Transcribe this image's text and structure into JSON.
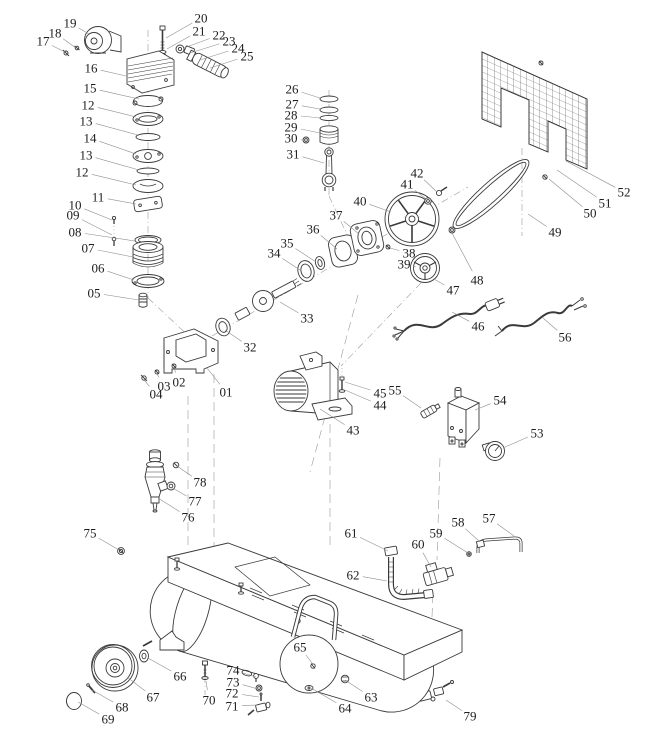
{
  "diagram": {
    "type": "exploded-parts-diagram",
    "subject": "air-compressor",
    "canvas": {
      "width": 649,
      "height": 755
    },
    "colors": {
      "background": "#ffffff",
      "line": "#3a3a3a",
      "leader": "#8f8f8f",
      "construction": "#9a9a9a",
      "label": "#1d1d1d"
    },
    "label_font_size": 13,
    "part_labels": [
      {
        "num": "01",
        "x": 226,
        "y": 392,
        "tx": 207,
        "ty": 368
      },
      {
        "num": "02",
        "x": 179,
        "y": 382,
        "tx": 174,
        "ty": 368
      },
      {
        "num": "03",
        "x": 164,
        "y": 386,
        "tx": 157,
        "ty": 374
      },
      {
        "num": "04",
        "x": 156,
        "y": 394,
        "tx": 144,
        "ty": 380
      },
      {
        "num": "05",
        "x": 94,
        "y": 293,
        "tx": 139,
        "ty": 300
      },
      {
        "num": "06",
        "x": 98,
        "y": 268,
        "tx": 134,
        "ty": 280
      },
      {
        "num": "07",
        "x": 88,
        "y": 248,
        "tx": 133,
        "ty": 257
      },
      {
        "num": "08",
        "x": 75,
        "y": 232,
        "tx": 135,
        "ty": 241
      },
      {
        "num": "09",
        "x": 73,
        "y": 215,
        "tx": 112,
        "ty": 235
      },
      {
        "num": "10",
        "x": 75,
        "y": 205,
        "tx": 112,
        "ty": 220
      },
      {
        "num": "11",
        "x": 98,
        "y": 197,
        "tx": 136,
        "ty": 204
      },
      {
        "num": "12",
        "x": 88,
        "y": 105,
        "tx": 136,
        "ty": 117
      },
      {
        "num": "13",
        "x": 86,
        "y": 121,
        "tx": 138,
        "ty": 135
      },
      {
        "num": "14",
        "x": 90,
        "y": 138,
        "tx": 136,
        "ty": 154
      },
      {
        "num": "13",
        "x": 86,
        "y": 155,
        "tx": 139,
        "ty": 170
      },
      {
        "num": "12",
        "x": 82,
        "y": 172,
        "tx": 136,
        "ty": 185
      },
      {
        "num": "15",
        "x": 90,
        "y": 88,
        "tx": 139,
        "ty": 99
      },
      {
        "num": "16",
        "x": 91,
        "y": 68,
        "tx": 126,
        "ty": 76
      },
      {
        "num": "17",
        "x": 43,
        "y": 41,
        "tx": 65,
        "ty": 52
      },
      {
        "num": "18",
        "x": 55,
        "y": 33,
        "tx": 76,
        "ty": 48
      },
      {
        "num": "19",
        "x": 70,
        "y": 23,
        "tx": 89,
        "ty": 34
      },
      {
        "num": "20",
        "x": 201,
        "y": 18,
        "tx": 166,
        "ty": 38
      },
      {
        "num": "21",
        "x": 199,
        "y": 31,
        "tx": 167,
        "ty": 49
      },
      {
        "num": "22",
        "x": 219,
        "y": 35,
        "tx": 184,
        "ty": 48
      },
      {
        "num": "23",
        "x": 229,
        "y": 41,
        "tx": 190,
        "ty": 53
      },
      {
        "num": "24",
        "x": 238,
        "y": 48,
        "tx": 200,
        "ty": 60
      },
      {
        "num": "25",
        "x": 247,
        "y": 56,
        "tx": 210,
        "ty": 68
      },
      {
        "num": "26",
        "x": 292,
        "y": 89,
        "tx": 320,
        "ty": 98
      },
      {
        "num": "27",
        "x": 292,
        "y": 104,
        "tx": 320,
        "ty": 109
      },
      {
        "num": "28",
        "x": 291,
        "y": 115,
        "tx": 320,
        "ty": 118
      },
      {
        "num": "29",
        "x": 291,
        "y": 127,
        "tx": 320,
        "ty": 133
      },
      {
        "num": "30",
        "x": 291,
        "y": 138,
        "tx": 304,
        "ty": 140
      },
      {
        "num": "31",
        "x": 293,
        "y": 154,
        "tx": 324,
        "ty": 163
      },
      {
        "num": "32",
        "x": 250,
        "y": 347,
        "tx": 225,
        "ty": 330
      },
      {
        "num": "33",
        "x": 307,
        "y": 318,
        "tx": 280,
        "ty": 302
      },
      {
        "num": "34",
        "x": 274,
        "y": 253,
        "tx": 300,
        "ty": 270
      },
      {
        "num": "35",
        "x": 287,
        "y": 243,
        "tx": 316,
        "ty": 262
      },
      {
        "num": "36",
        "x": 313,
        "y": 229,
        "tx": 337,
        "ty": 249
      },
      {
        "num": "37",
        "x": 336,
        "y": 215,
        "tx": 359,
        "ty": 234
      },
      {
        "num": "38",
        "x": 409,
        "y": 253,
        "tx": 390,
        "ty": 248
      },
      {
        "num": "39",
        "x": 404,
        "y": 264,
        "tx": 416,
        "ty": 267
      },
      {
        "num": "40",
        "x": 360,
        "y": 201,
        "tx": 391,
        "ty": 212
      },
      {
        "num": "41",
        "x": 407,
        "y": 184,
        "tx": 426,
        "ty": 199
      },
      {
        "num": "42",
        "x": 417,
        "y": 173,
        "tx": 437,
        "ty": 192
      },
      {
        "num": "43",
        "x": 353,
        "y": 430,
        "tx": 320,
        "ty": 409
      },
      {
        "num": "44",
        "x": 380,
        "y": 405,
        "tx": 345,
        "ty": 390
      },
      {
        "num": "45",
        "x": 380,
        "y": 393,
        "tx": 345,
        "ty": 382
      },
      {
        "num": "46",
        "x": 478,
        "y": 326,
        "tx": 452,
        "ty": 312
      },
      {
        "num": "47",
        "x": 453,
        "y": 290,
        "tx": 434,
        "ty": 279
      },
      {
        "num": "48",
        "x": 477,
        "y": 280,
        "tx": 452,
        "ty": 233
      },
      {
        "num": "49",
        "x": 555,
        "y": 232,
        "tx": 528,
        "ty": 214
      },
      {
        "num": "50",
        "x": 590,
        "y": 213,
        "tx": 549,
        "ty": 179
      },
      {
        "num": "51",
        "x": 605,
        "y": 203,
        "tx": 557,
        "ty": 170
      },
      {
        "num": "52",
        "x": 624,
        "y": 192,
        "tx": 566,
        "ty": 161
      },
      {
        "num": "53",
        "x": 537,
        "y": 433,
        "tx": 503,
        "ty": 448
      },
      {
        "num": "54",
        "x": 500,
        "y": 400,
        "tx": 475,
        "ty": 410
      },
      {
        "num": "55",
        "x": 395,
        "y": 390,
        "tx": 421,
        "ty": 408
      },
      {
        "num": "56",
        "x": 565,
        "y": 337,
        "tx": 543,
        "ty": 318
      },
      {
        "num": "57",
        "x": 489,
        "y": 518,
        "tx": 514,
        "ty": 536
      },
      {
        "num": "58",
        "x": 458,
        "y": 522,
        "tx": 480,
        "ty": 542
      },
      {
        "num": "59",
        "x": 436,
        "y": 533,
        "tx": 468,
        "ty": 553
      },
      {
        "num": "60",
        "x": 418,
        "y": 544,
        "tx": 431,
        "ty": 567
      },
      {
        "num": "61",
        "x": 351,
        "y": 533,
        "tx": 388,
        "ty": 551
      },
      {
        "num": "62",
        "x": 353,
        "y": 575,
        "tx": 387,
        "ty": 581
      },
      {
        "num": "63",
        "x": 371,
        "y": 697,
        "tx": 345,
        "ty": 680
      },
      {
        "num": "64",
        "x": 345,
        "y": 708,
        "tx": 311,
        "ty": 688
      },
      {
        "num": "65",
        "x": 300,
        "y": 647,
        "tx": 312,
        "ty": 663
      },
      {
        "num": "66",
        "x": 180,
        "y": 676,
        "tx": 148,
        "ty": 658
      },
      {
        "num": "67",
        "x": 153,
        "y": 697,
        "tx": 127,
        "ty": 677
      },
      {
        "num": "68",
        "x": 122,
        "y": 707,
        "tx": 92,
        "ty": 690
      },
      {
        "num": "69",
        "x": 108,
        "y": 719,
        "tx": 78,
        "ty": 702
      },
      {
        "num": "70",
        "x": 209,
        "y": 700,
        "tx": 206,
        "ty": 681
      },
      {
        "num": "71",
        "x": 232,
        "y": 706,
        "tx": 257,
        "ty": 705
      },
      {
        "num": "72",
        "x": 232,
        "y": 693,
        "tx": 259,
        "ty": 697
      },
      {
        "num": "73",
        "x": 233,
        "y": 682,
        "tx": 258,
        "ty": 689
      },
      {
        "num": "74",
        "x": 233,
        "y": 670,
        "tx": 256,
        "ty": 677
      },
      {
        "num": "75",
        "x": 90,
        "y": 533,
        "tx": 119,
        "ty": 550
      },
      {
        "num": "76",
        "x": 188,
        "y": 517,
        "tx": 158,
        "ty": 498
      },
      {
        "num": "77",
        "x": 195,
        "y": 501,
        "tx": 171,
        "ty": 487
      },
      {
        "num": "78",
        "x": 200,
        "y": 482,
        "tx": 177,
        "ty": 466
      },
      {
        "num": "79",
        "x": 470,
        "y": 716,
        "tx": 446,
        "ty": 700
      }
    ]
  }
}
